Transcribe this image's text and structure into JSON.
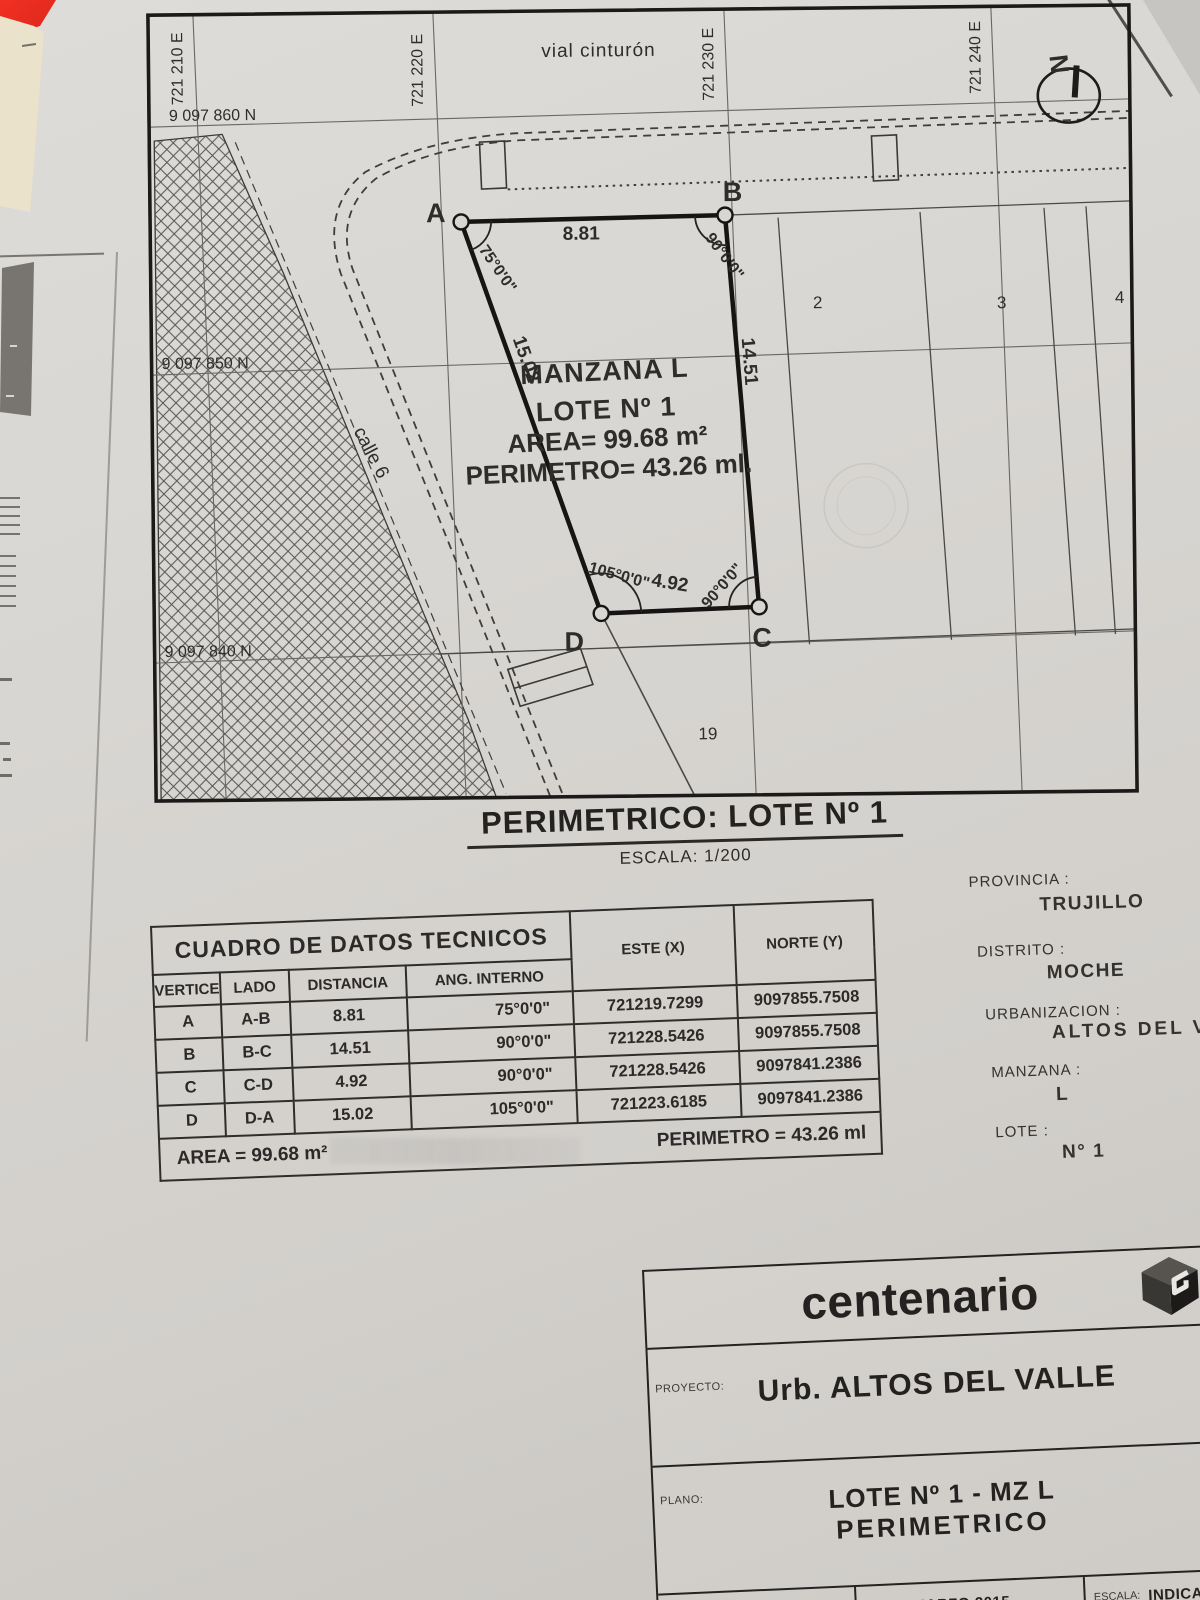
{
  "map": {
    "grid_east_labels": [
      "721 210 E",
      "721 220 E",
      "721 230 E",
      "721 240 E"
    ],
    "grid_north_labels": [
      "9 097 860 N",
      "9 097 850 N",
      "9 097 840 N"
    ],
    "street_top": "vial cinturón",
    "street_left": "calle 6",
    "compass": "N",
    "vertices": [
      "A",
      "B",
      "C",
      "D"
    ],
    "lot_text": [
      "MANZANA L",
      "LOTE Nº 1",
      "AREA= 99.68 m²",
      "PERIMETRO= 43.26 ml."
    ],
    "neighbor_lots": [
      "2",
      "3",
      "4",
      "19"
    ]
  },
  "title": {
    "main": "PERIMETRICO: LOTE  Nº 1",
    "scale": "ESCALA: 1/200"
  },
  "tech_table": {
    "title": "CUADRO DE DATOS TECNICOS",
    "headers": [
      "VERTICE",
      "LADO",
      "DISTANCIA",
      "ANG. INTERNO",
      "ESTE (X)",
      "NORTE (Y)"
    ],
    "rows": [
      {
        "vertice": "A",
        "lado": "A-B",
        "distancia": "8.81",
        "angulo": "75°0'0\"",
        "este": "721219.7299",
        "norte": "9097855.7508"
      },
      {
        "vertice": "B",
        "lado": "B-C",
        "distancia": "14.51",
        "angulo": "90°0'0\"",
        "este": "721228.5426",
        "norte": "9097855.7508"
      },
      {
        "vertice": "C",
        "lado": "C-D",
        "distancia": "4.92",
        "angulo": "90°0'0\"",
        "este": "721228.5426",
        "norte": "9097841.2386"
      },
      {
        "vertice": "D",
        "lado": "D-A",
        "distancia": "15.02",
        "angulo": "105°0'0\"",
        "este": "721223.6185",
        "norte": "9097841.2386"
      }
    ],
    "area": "AREA = 99.68 m²",
    "perimetro": "PERIMETRO = 43.26 ml"
  },
  "location": {
    "provincia_label": "PROVINCIA :",
    "provincia": "TRUJILLO",
    "distrito_label": "DISTRITO :",
    "distrito": "MOCHE",
    "urbanizacion_label": "URBANIZACION :",
    "urbanizacion": "ALTOS DEL VALLE",
    "manzana_label": "MANZANA :",
    "manzana": "L",
    "lote_label": "LOTE :",
    "lote": "N° 1"
  },
  "titleblock": {
    "company": "centenario",
    "proyecto_label": "PROYECTO:",
    "proyecto": "Urb. ALTOS DEL VALLE",
    "plano_label": "PLANO:",
    "plano_line1": "LOTE Nº 1  - MZ L",
    "plano_line2": "PERIMETRICO",
    "dibujo_label": "DIBUJO:",
    "dibujo": "TECNIPLAN SAC",
    "fecha_label": "FECHA:",
    "fecha": "MARZO 2015",
    "escala_label": "ESCALA:",
    "escala": "INDICADA"
  }
}
